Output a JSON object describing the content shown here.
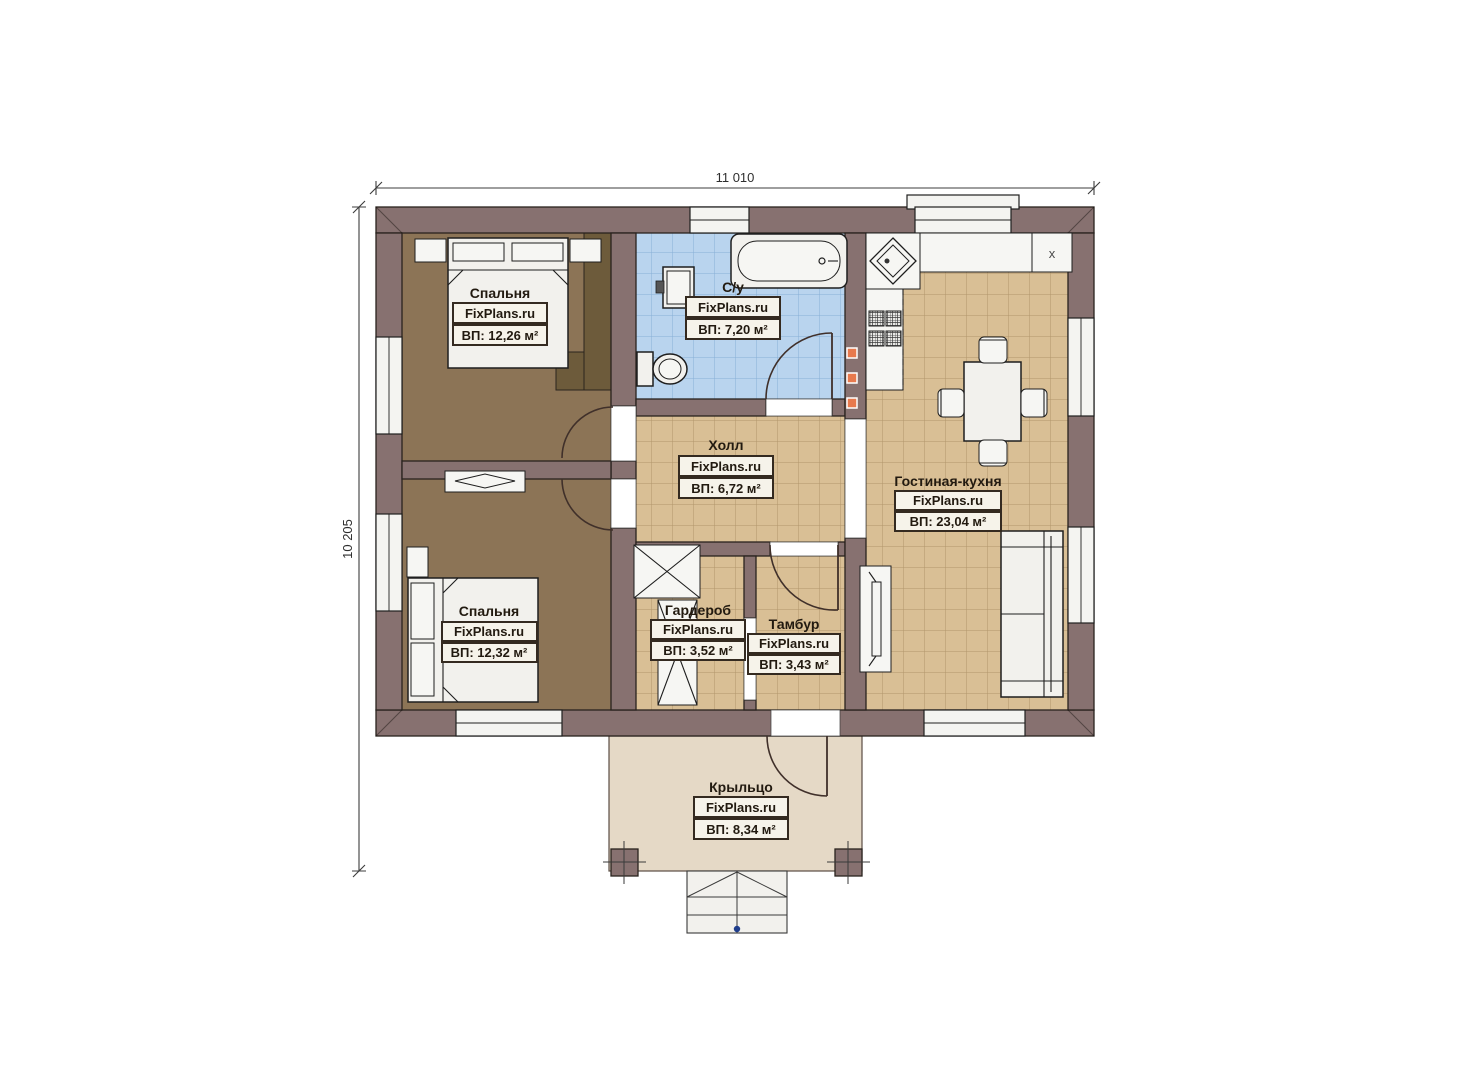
{
  "plan": {
    "source_watermark": "FixPlans.ru",
    "dimensions": {
      "width_label": "11 010",
      "height_label": "10 205"
    },
    "rooms": [
      {
        "name": "Спальня",
        "watermark": "FixPlans.ru",
        "area": "ВП: 12,26 м²"
      },
      {
        "name": "С/у",
        "watermark": "FixPlans.ru",
        "area": "ВП: 7,20 м²"
      },
      {
        "name": "Холл",
        "watermark": "FixPlans.ru",
        "area": "ВП: 6,72 м²"
      },
      {
        "name": "Гостиная-кухня",
        "watermark": "FixPlans.ru",
        "area": "ВП: 23,04 м²"
      },
      {
        "name": "Спальня",
        "watermark": "FixPlans.ru",
        "area": "ВП: 12,32 м²"
      },
      {
        "name": "Гардероб",
        "watermark": "FixPlans.ru",
        "area": "ВП: 3,52 м²"
      },
      {
        "name": "Тамбур",
        "watermark": "FixPlans.ru",
        "area": "ВП: 3,43 м²"
      },
      {
        "name": "Крыльцо",
        "watermark": "FixPlans.ru",
        "area": "ВП: 8,34 м²"
      }
    ],
    "markers": {
      "fridge_label": "x"
    },
    "colors": {
      "wall": "#877170",
      "bedroom_floor": "#8C7456",
      "closet": "#6D5B3B",
      "tile_floor": "#D9BF95",
      "bath_tile": "#B9D4EE",
      "porch_floor": "#E5D9C6",
      "vent_accent": "#E87A4E"
    }
  }
}
